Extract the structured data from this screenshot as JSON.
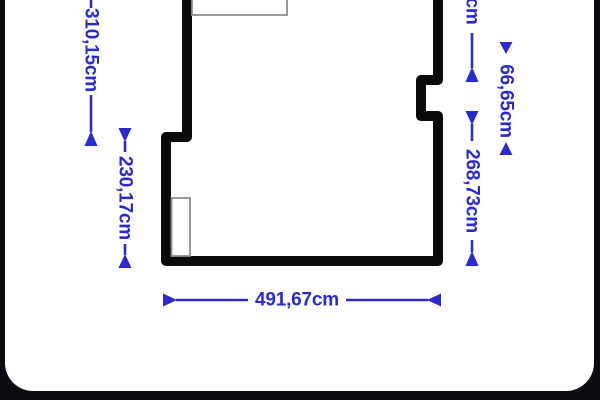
{
  "colors": {
    "background": "#0b0b12",
    "card": "#ffffff",
    "accent_blue": "#2a2ad0",
    "wall_black": "#0a0a0a",
    "door_marker_gray": "#8f8f8f"
  },
  "floor_plan": {
    "unit": "cm",
    "dimensions": {
      "left_outer_wall": "310,15cm",
      "left_inner_wall": "230,17cm",
      "right_top_wall_partial": "cm",
      "right_notch": "66,65cm",
      "right_lower_wall": "268,73cm",
      "bottom_wall": "491,67cm"
    }
  }
}
